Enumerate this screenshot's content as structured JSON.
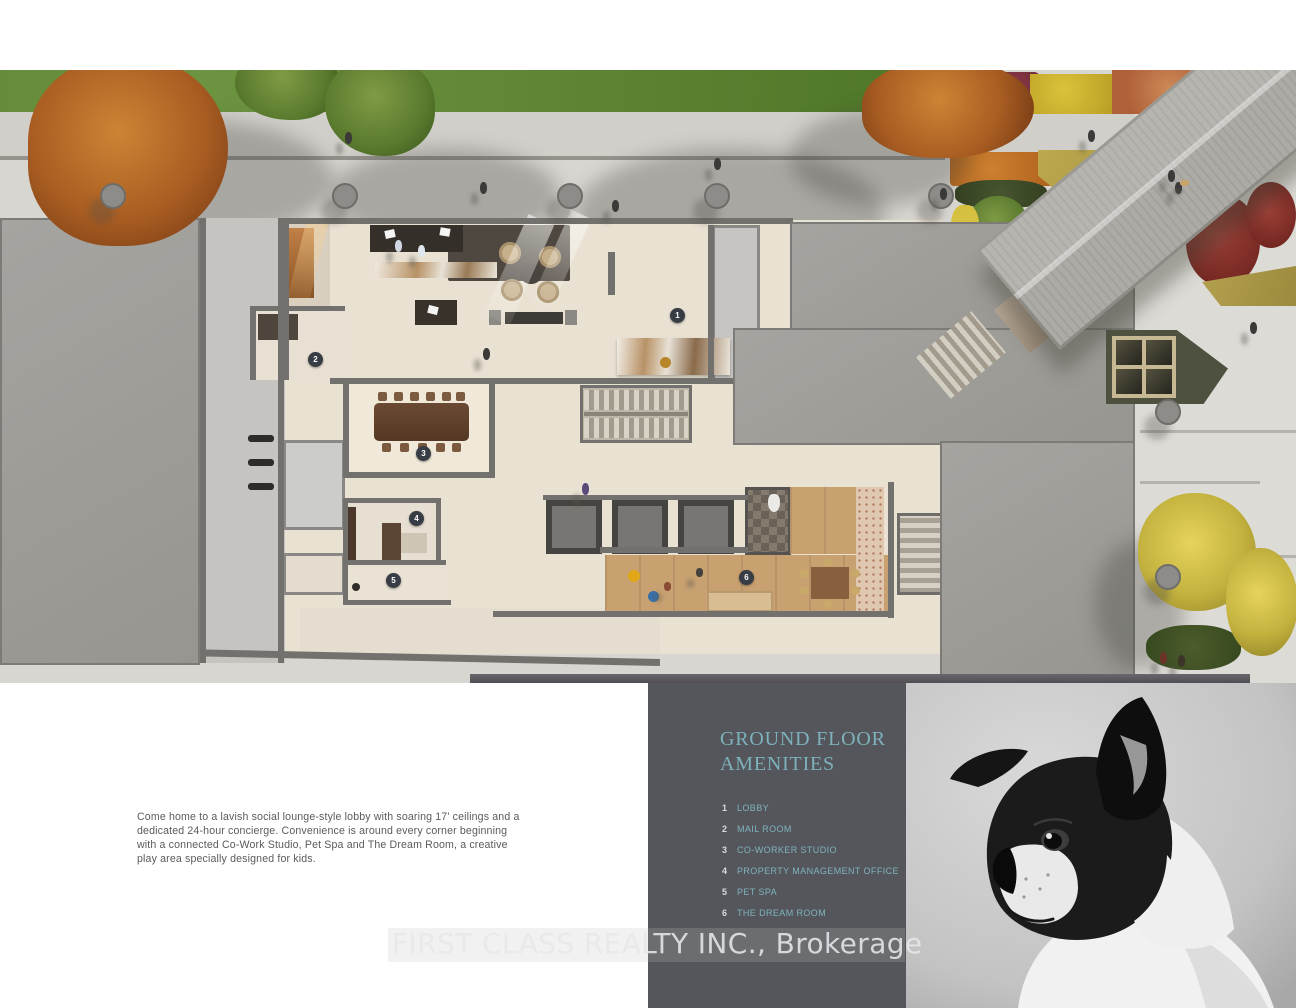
{
  "legend": {
    "panel_color": "#54565b",
    "accent_color": "#7db1bb",
    "title_line1": "GROUND FLOOR",
    "title_line2": "AMENITIES",
    "items": [
      {
        "num": "1",
        "label": "LOBBY"
      },
      {
        "num": "2",
        "label": "MAIL ROOM"
      },
      {
        "num": "3",
        "label": "CO-WORKER STUDIO"
      },
      {
        "num": "4",
        "label": "PROPERTY MANAGEMENT OFFICE"
      },
      {
        "num": "5",
        "label": "PET SPA"
      },
      {
        "num": "6",
        "label": "THE DREAM ROOM"
      }
    ]
  },
  "plan": {
    "markers": [
      {
        "num": "1"
      },
      {
        "num": "2"
      },
      {
        "num": "3"
      },
      {
        "num": "4"
      },
      {
        "num": "5"
      },
      {
        "num": "6"
      }
    ]
  },
  "description": {
    "text": "Come home to a lavish social lounge-style lobby with soaring 17' ceilings and a dedicated 24-hour concierge. Convenience is around every corner beginning with a connected Co-Work Studio, Pet Spa and The Dream Room, a creative play area specially designed for kids."
  },
  "watermark": {
    "text": "FIRST CLASS REALTY INC., Brokerage"
  },
  "photo": {
    "subject": "black and white french bulldog puppy"
  }
}
